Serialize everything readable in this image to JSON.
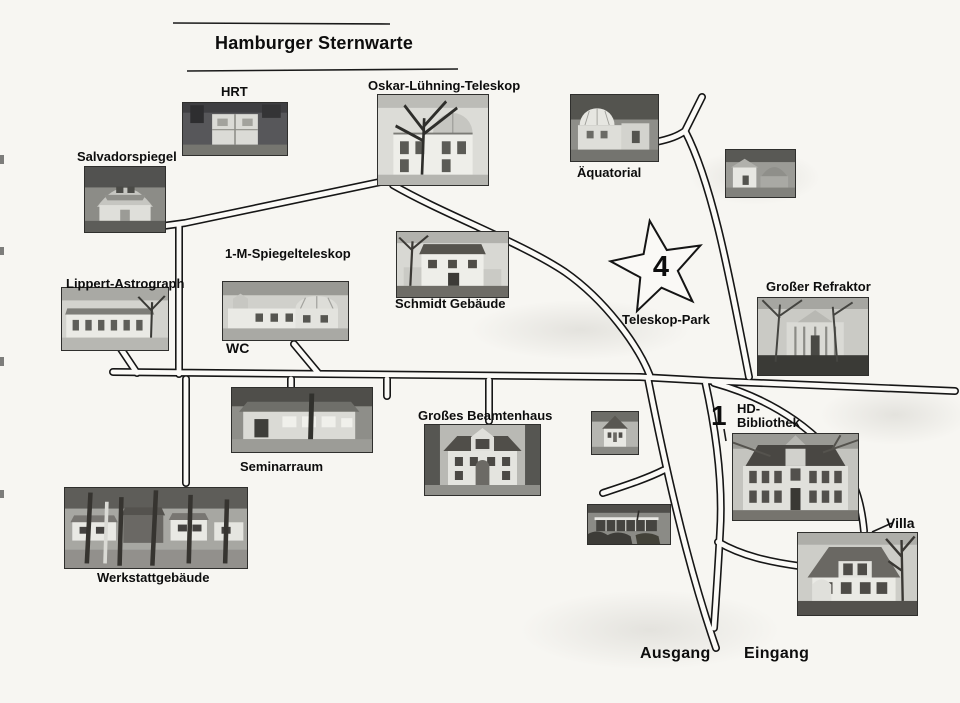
{
  "title": "Hamburger Sternwarte",
  "park": {
    "number": "4",
    "name": "Teleskop-Park"
  },
  "hd_library": {
    "number": "1",
    "line1": "HD-",
    "line2": "Bibliothek"
  },
  "wc_label": "WC",
  "exit_label": "Ausgang",
  "entrance_label": "Eingang",
  "buildings": [
    {
      "name": "HRT",
      "photo": "hrt"
    },
    {
      "name": "Salvadorspiegel",
      "photo": "barrel"
    },
    {
      "name": "Oskar-Lühning-Teleskop",
      "photo": "domehouse"
    },
    {
      "name": "Äquatorial",
      "photo": "dome"
    },
    {
      "photo": "meridian"
    },
    {
      "name": "Lippert-Astrograph",
      "photo": "longlow"
    },
    {
      "name": "1-M-Spiegelteleskop",
      "photo": "longdome"
    },
    {
      "name": "Schmidt Gebäude",
      "photo": "schmidt"
    },
    {
      "name": "Großer Refraktor",
      "photo": "refraktor"
    },
    {
      "name": "Seminarraum",
      "photo": "seminar"
    },
    {
      "name": "Großes Beamtenhaus",
      "photo": "bighouse"
    },
    {
      "photo": "smallhouse"
    },
    {
      "photo": "baroque"
    },
    {
      "photo": "modern"
    },
    {
      "name": "Villa",
      "photo": "villa"
    },
    {
      "name": "Werkstattgebäude",
      "photo": "sheds"
    }
  ]
}
